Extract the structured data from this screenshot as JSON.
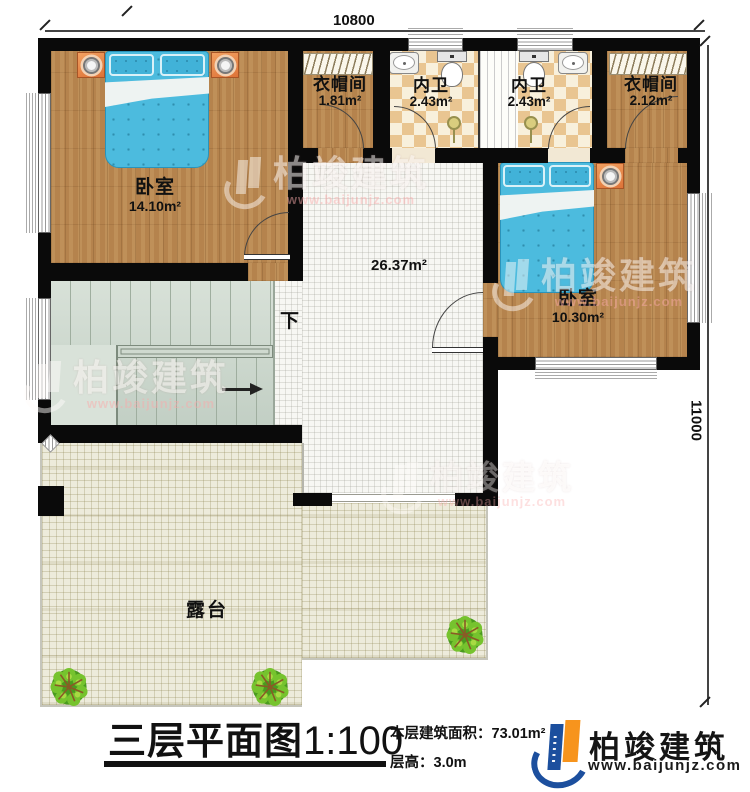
{
  "dimensions": {
    "top": "10800",
    "right": "11000"
  },
  "rooms": {
    "bedroom1": {
      "name": "卧室",
      "area": "14.10m²"
    },
    "cloakroom1": {
      "name": "衣帽间",
      "area": "1.81m²"
    },
    "bathroom1": {
      "name": "内卫",
      "area": "2.43m²"
    },
    "bathroom2": {
      "name": "内卫",
      "area": "2.43m²"
    },
    "cloakroom2": {
      "name": "衣帽间",
      "area": "2.12m²"
    },
    "bedroom2": {
      "name": "卧室",
      "area": "10.30m²"
    },
    "hall": {
      "area": "26.37m²"
    },
    "stairs": {
      "direction": "下"
    },
    "terrace": {
      "name": "露台"
    }
  },
  "title": {
    "text": "三层平面图",
    "scale": "1:100"
  },
  "info": {
    "area_label": "本层建筑面积：",
    "area_value": "73.01m²",
    "height_label": "层高：",
    "height_value": "3.0m"
  },
  "logo": {
    "company": "柏竣建筑",
    "website": "www.baijunjz.com"
  },
  "watermark": {
    "company": "柏竣建筑",
    "website": "www.baijunjz.com"
  },
  "colors": {
    "wall": "#0a0a0a",
    "wood": "#b5834d",
    "tile_dark": "#e9c591",
    "terrace": "#edebdb",
    "stairs": "#ccd7cc",
    "bed_blue": "#4cbbde",
    "logo_blue": "#1c4f9e",
    "logo_orange": "#f7941d"
  }
}
